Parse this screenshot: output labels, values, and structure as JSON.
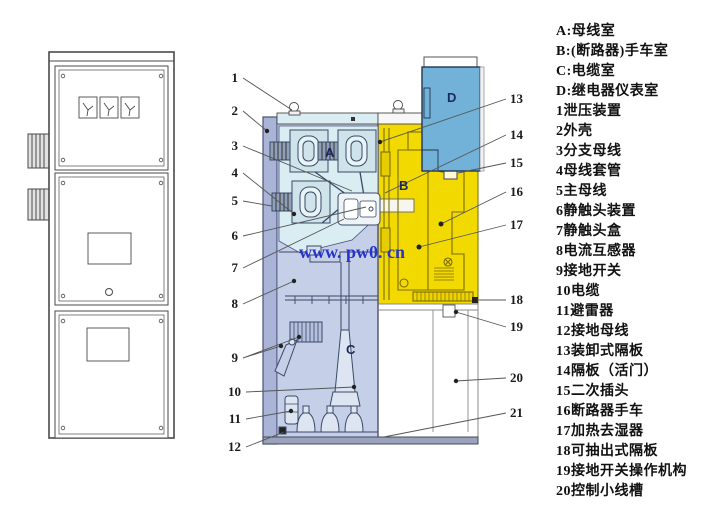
{
  "figure": {
    "title": "switchgear-cabinet-structure-diagram",
    "watermark": "www. pw0. cn"
  },
  "legend": {
    "items": [
      "A:母线室",
      "B:(断路器)手车室",
      "C:电缆室",
      "D:继电器仪表室",
      "1泄压装置",
      "2外壳",
      "3分支母线",
      "4母线套管",
      "5主母线",
      "6静触头装置",
      "7静触头盒",
      "8电流互感器",
      "9接地开关",
      "10电缆",
      "11避雷器",
      "12接地母线",
      "13装卸式隔板",
      "14隔板（活门）",
      "15二次插头",
      "16断路器手车",
      "17加热去湿器",
      "18可抽出式隔板",
      "19接地开关操作机构",
      "20控制小线槽"
    ]
  },
  "section": {
    "compartments": {
      "a": "A",
      "b": "B",
      "c": "C",
      "d": "D"
    },
    "callouts_left": [
      "1",
      "2",
      "3",
      "4",
      "5",
      "6",
      "7",
      "8",
      "9",
      "10",
      "11",
      "12"
    ],
    "callouts_right": [
      "13",
      "14",
      "15",
      "16",
      "17",
      "18",
      "19",
      "20",
      "21"
    ],
    "colors": {
      "shell_wall": "#aab4d6",
      "compartment_a": "#daedf2",
      "compartment_b": "#f2da00",
      "compartment_c": "#c5cfe8",
      "compartment_d": "#72b1d8",
      "watermark_blue": "#2433cc"
    }
  }
}
